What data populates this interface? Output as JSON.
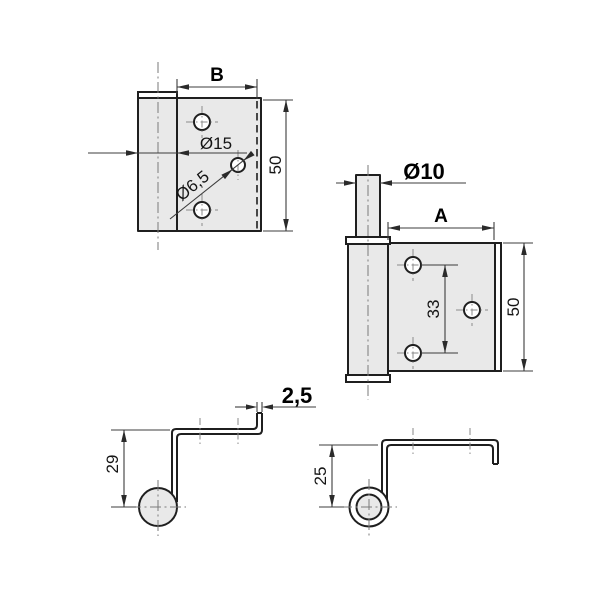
{
  "drawing": {
    "kind": "hinge-technical-drawing",
    "colors": {
      "background": "#ffffff",
      "part_fill": "#e9e9e9",
      "outline": "#1f1f1f",
      "dimension_line": "#3c3c3c",
      "centerline": "#7a7a7a"
    },
    "views": {
      "front_left": {
        "name": "front view - left hinge leaf",
        "width_label": "B",
        "height_value": "50",
        "barrel_diameter": "Ø15",
        "hole_diameter": "Ø6,5"
      },
      "front_right": {
        "name": "front view - right hinge leaf with pin",
        "pin_diameter": "Ø10",
        "width_label": "A",
        "height_value": "50",
        "hole_spacing": "33"
      },
      "profile_left": {
        "name": "side profile - left leaf",
        "offset_height": "29",
        "material_thickness": "2,5"
      },
      "profile_right": {
        "name": "side profile - right leaf",
        "offset_height": "25"
      }
    }
  }
}
